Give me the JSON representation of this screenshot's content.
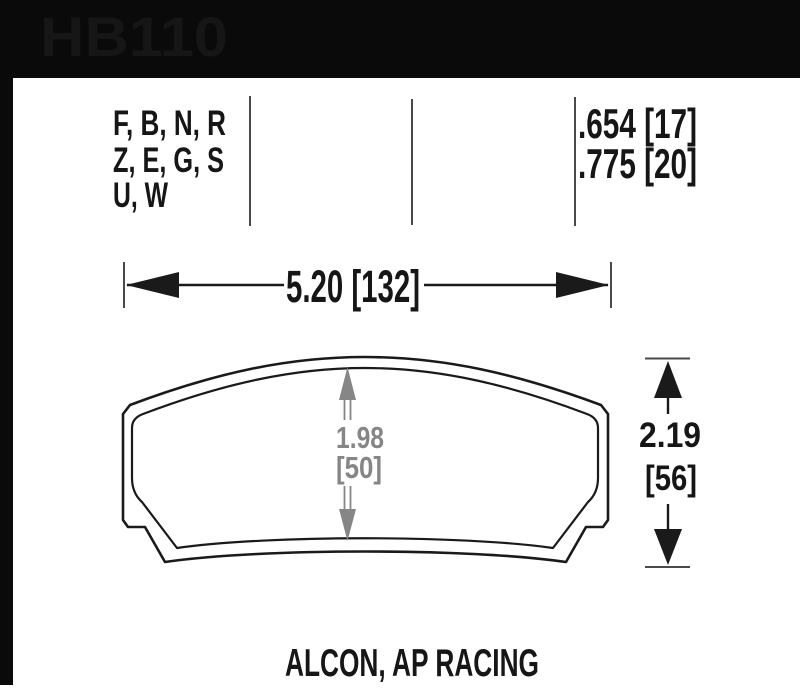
{
  "header": {
    "part_number": "HB110"
  },
  "spec": {
    "compounds": [
      "F, B, N, R",
      "Z, E, G, S",
      "U, W"
    ],
    "thicknesses": [
      ".654 [17]",
      ".775 [20]"
    ]
  },
  "dims": {
    "width": "5.20 [132]",
    "center_height": {
      "inches": "1.98",
      "mm": "[50]"
    },
    "overall_height": {
      "inches": "2.19",
      "mm": "[56]"
    }
  },
  "caption": "ALCON, AP RACING",
  "colors": {
    "bar": "#0a0a0a",
    "ink": "#161616",
    "line_gray": "#4a4a4a",
    "dim_gray": "#868686",
    "bg": "#ffffff"
  }
}
